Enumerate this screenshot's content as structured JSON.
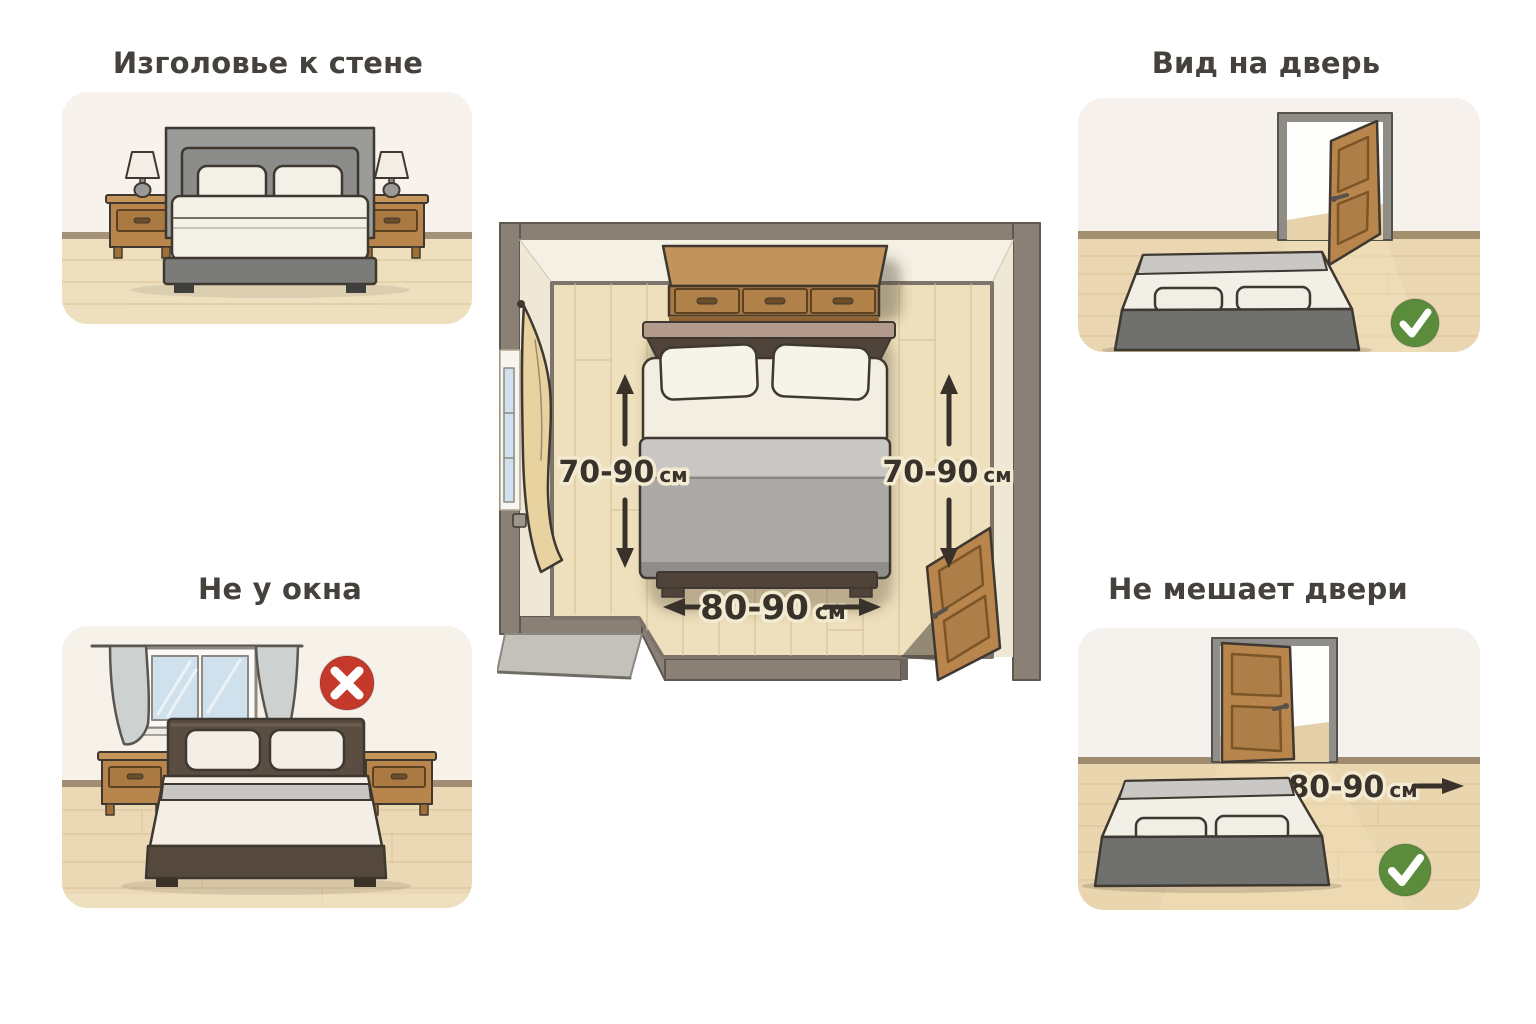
{
  "page": {
    "type": "infographic",
    "language": "ru",
    "background": "#ffffff"
  },
  "panels": {
    "headboard_to_wall": {
      "title": "Изголовье к стене"
    },
    "view_of_door": {
      "title": "Вид на дверь",
      "verdict": "approve"
    },
    "not_by_window": {
      "title": "Не у окна",
      "verdict": "reject"
    },
    "not_blocking_door": {
      "title": "Не мешает двери",
      "verdict": "approve",
      "clearance": {
        "value": "80-90",
        "unit": "см"
      }
    }
  },
  "floor_plan": {
    "left_clearance": {
      "value": "70-90",
      "unit": "см"
    },
    "right_clearance": {
      "value": "70-90",
      "unit": "см"
    },
    "foot_clearance": {
      "value": "80-90",
      "unit": "см"
    }
  },
  "icons": {
    "approve": "check-icon",
    "reject": "cross-icon"
  },
  "colors": {
    "approve_green": "#5a8c3c",
    "reject_red": "#c5392b",
    "measurement_text": "#38322a",
    "title_text": "#45423d",
    "plan_wall": "#8a8076",
    "wood": "#b8854d",
    "floor": "#eadcba"
  }
}
